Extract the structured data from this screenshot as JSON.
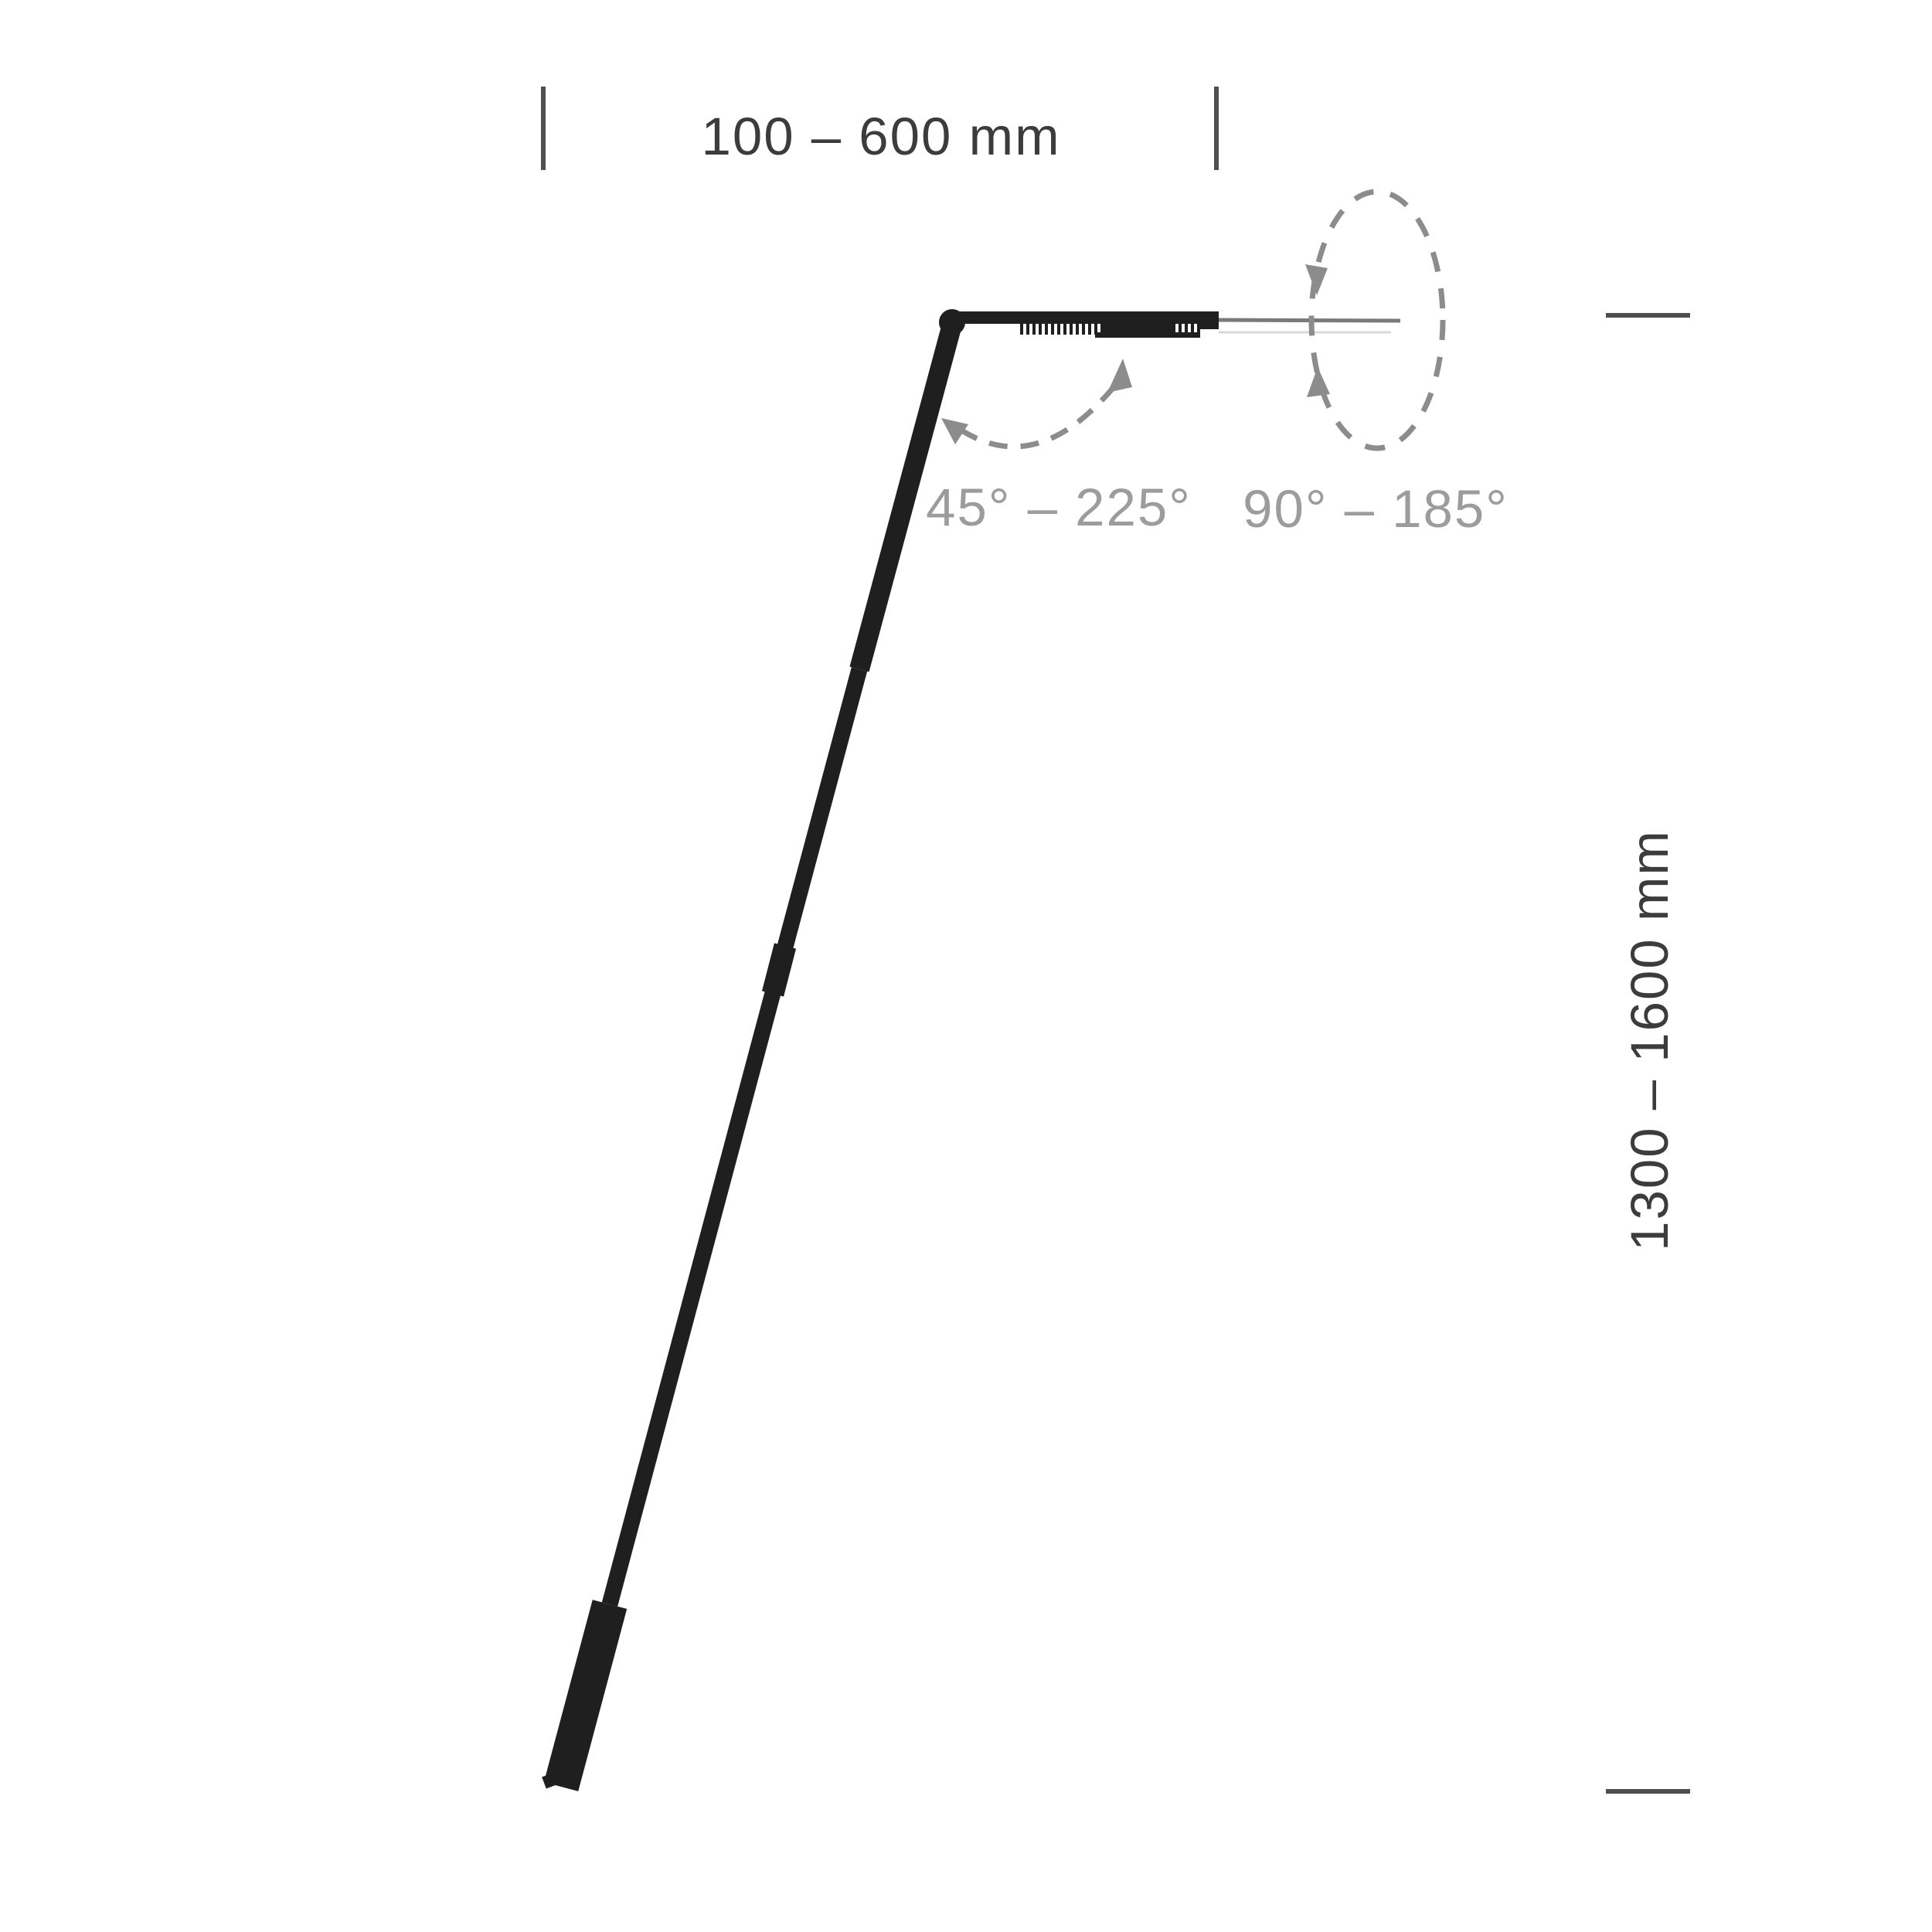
{
  "diagram": {
    "labels": {
      "arm_length_range": "100 – 600 mm",
      "height_range": "1300 – 1600 mm",
      "arm_tilt_range": "45° – 225°",
      "head_rotation_range": "90° – 185°"
    },
    "colors": {
      "lamp_ink": "#1f1f1f",
      "tick": "#4f4f4f",
      "dimension_text": "#3c3c3c",
      "angle_text": "#9c9c9c",
      "dashed_motion": "#8c8c8c",
      "head_axis_line": "#7a7a7a",
      "head_axis_line_faint": "#d8d8d8"
    }
  }
}
